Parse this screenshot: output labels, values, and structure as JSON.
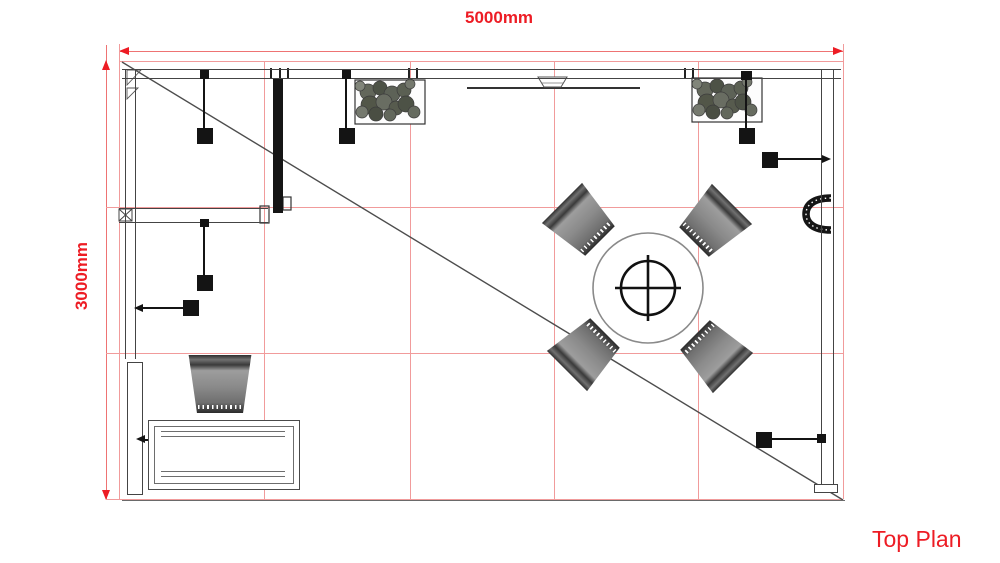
{
  "annotations": {
    "top_dimension": "5000mm",
    "left_dimension": "3000mm",
    "title": "Top Plan"
  },
  "colors": {
    "annotation_red": "#ed1c24",
    "grid_red": "#f19b9b",
    "wall_gray": "#444444",
    "chair_gray": "#858585"
  },
  "plan": {
    "grid_columns": 5,
    "grid_rows": 3,
    "grid_cell_mm": 1000,
    "objects": [
      "planter-top-left",
      "planter-top-right",
      "round-table-with-pedestal",
      "dining-chair-upper-left",
      "dining-chair-upper-right",
      "dining-chair-lower-left",
      "dining-chair-lower-right",
      "single-chair-bottom-left",
      "rectangular-table-bottom-left",
      "potted-plant-on-table",
      "ceiling-light-1",
      "ceiling-light-2",
      "ceiling-light-3",
      "ceiling-light-4",
      "ceiling-light-5",
      "ceiling-light-6",
      "ceiling-light-7",
      "wall-mounted-handle-right",
      "ceiling-beam-top-center",
      "diagonal-reference-line"
    ]
  }
}
